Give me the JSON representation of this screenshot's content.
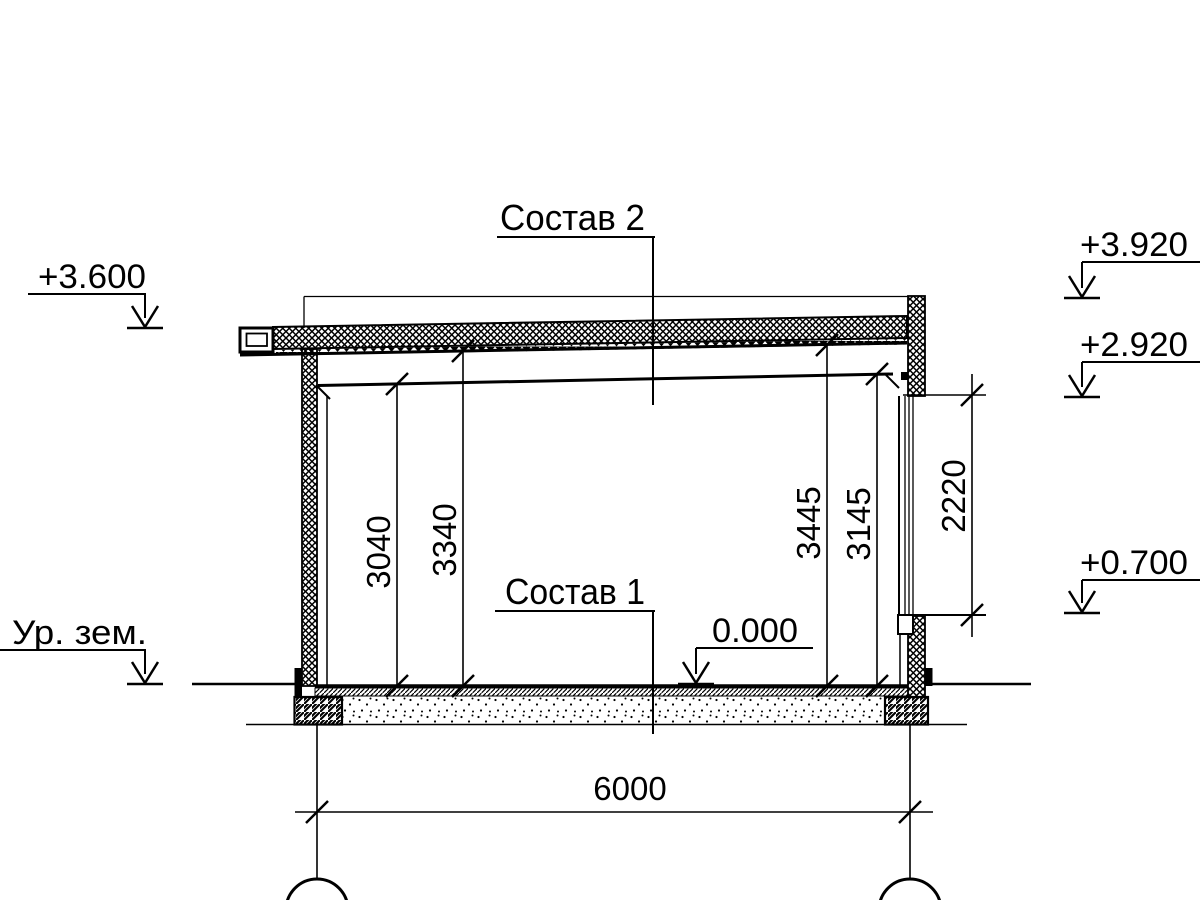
{
  "drawing": {
    "type": "architectural-section",
    "background_color": "#ffffff",
    "line_color": "#000000",
    "labels": {
      "composition2": "Состав 2",
      "composition1": "Состав 1",
      "ground_level": "Ур. зем."
    },
    "elevations": {
      "eaves_top": "+3.600",
      "parapet_top": "+3.920",
      "window_head": "+2.920",
      "window_sill": "+0.700",
      "floor_level": "0.000"
    },
    "dimensions": {
      "ceiling_height_left": "3040",
      "roof_underside_height_left": "3340",
      "roof_underside_height_right": "3445",
      "ceiling_height_right": "3145",
      "window_height": "2220",
      "span": "6000"
    }
  }
}
